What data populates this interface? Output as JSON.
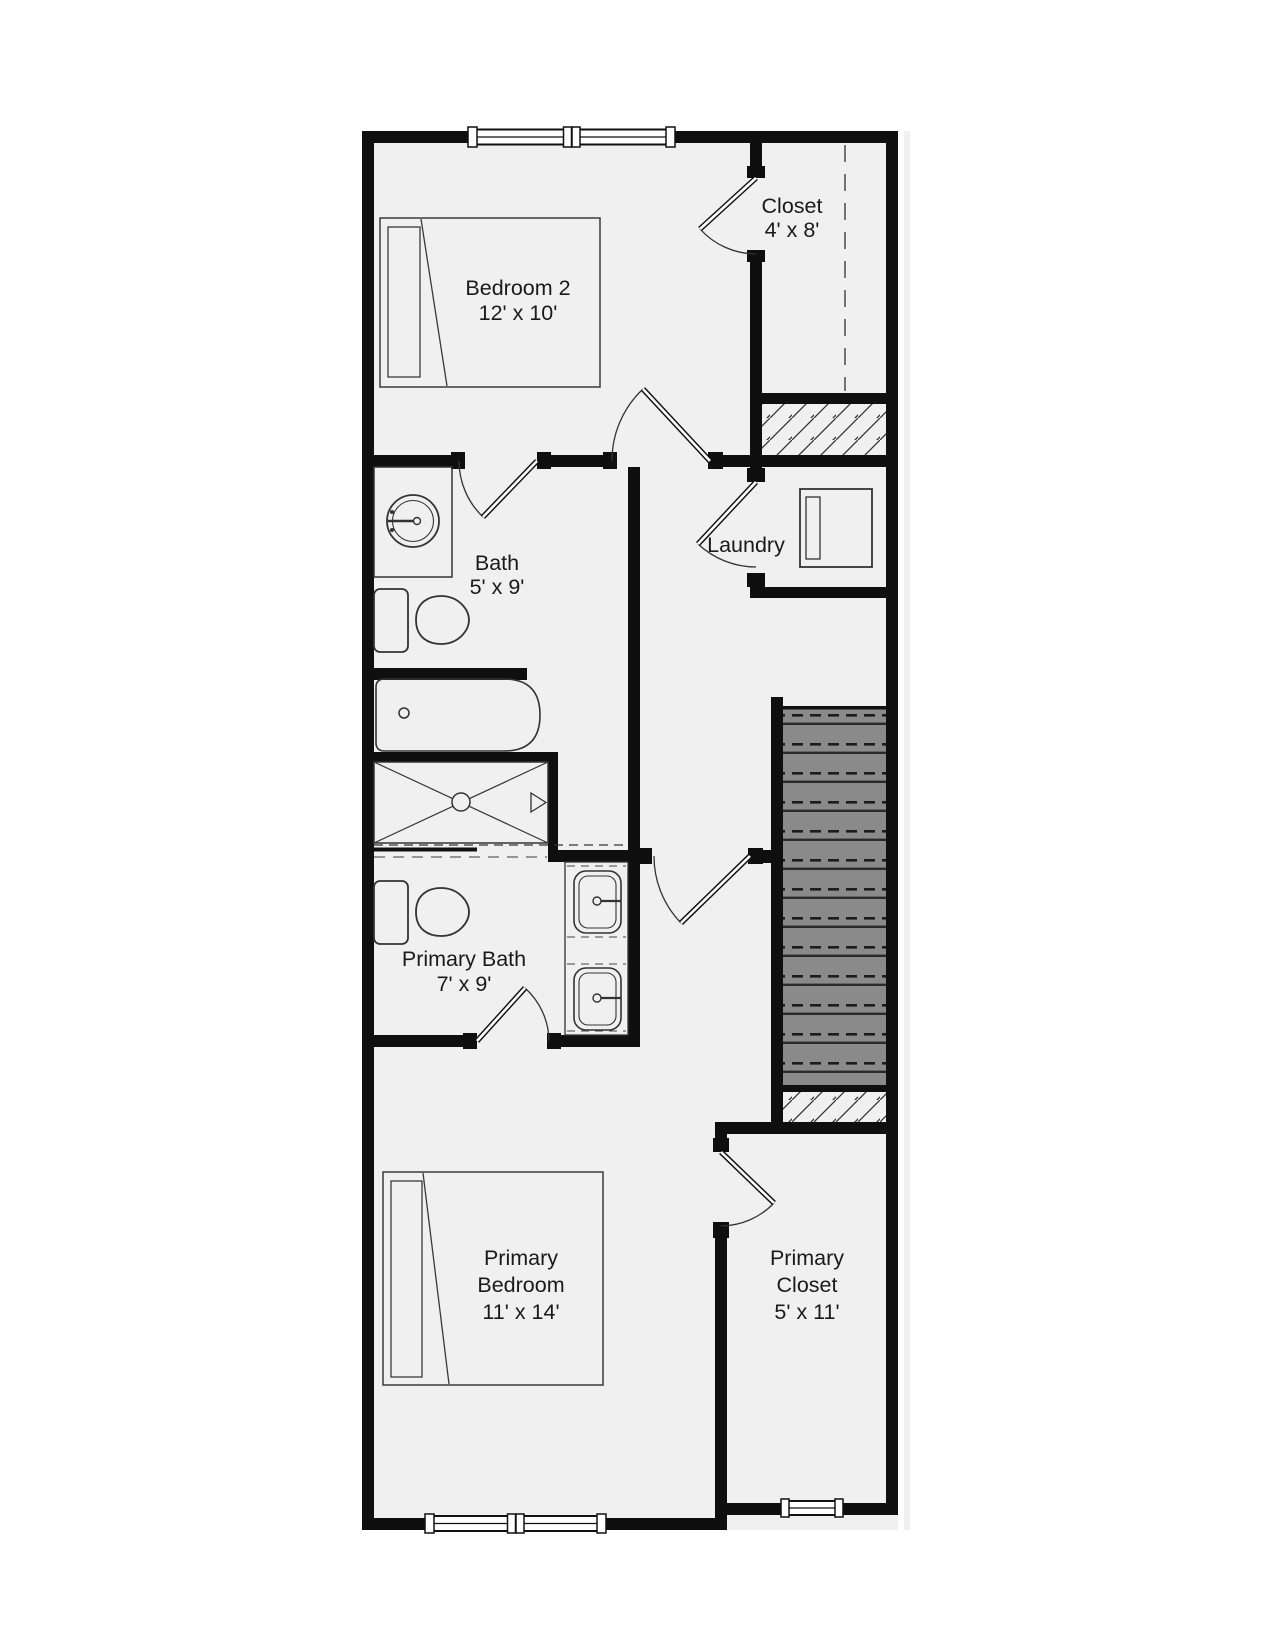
{
  "plan": {
    "title": "Second floor residential floor plan",
    "rooms": {
      "bedroom2": {
        "name": "Bedroom 2",
        "dims": "12' x 10'"
      },
      "closet": {
        "name": "Closet",
        "dims": "4' x 8'"
      },
      "bath": {
        "name": "Bath",
        "dims": "5' x 9'"
      },
      "laundry": {
        "name": "Laundry"
      },
      "primary_bath": {
        "name": "Primary Bath",
        "dims": "7' x 9'"
      },
      "primary_bedroom": {
        "line1": "Primary",
        "line2": "Bedroom",
        "dims": "11' x 14'"
      },
      "primary_closet": {
        "line1": "Primary",
        "line2": "Closet",
        "dims": "5' x 11'"
      }
    },
    "colors": {
      "wall": "#0f0f0f",
      "floor": "#f0f0f0",
      "stair_fill": "#8a8a8a",
      "text": "#1a1a1a",
      "fixture_line": "#333333"
    }
  }
}
